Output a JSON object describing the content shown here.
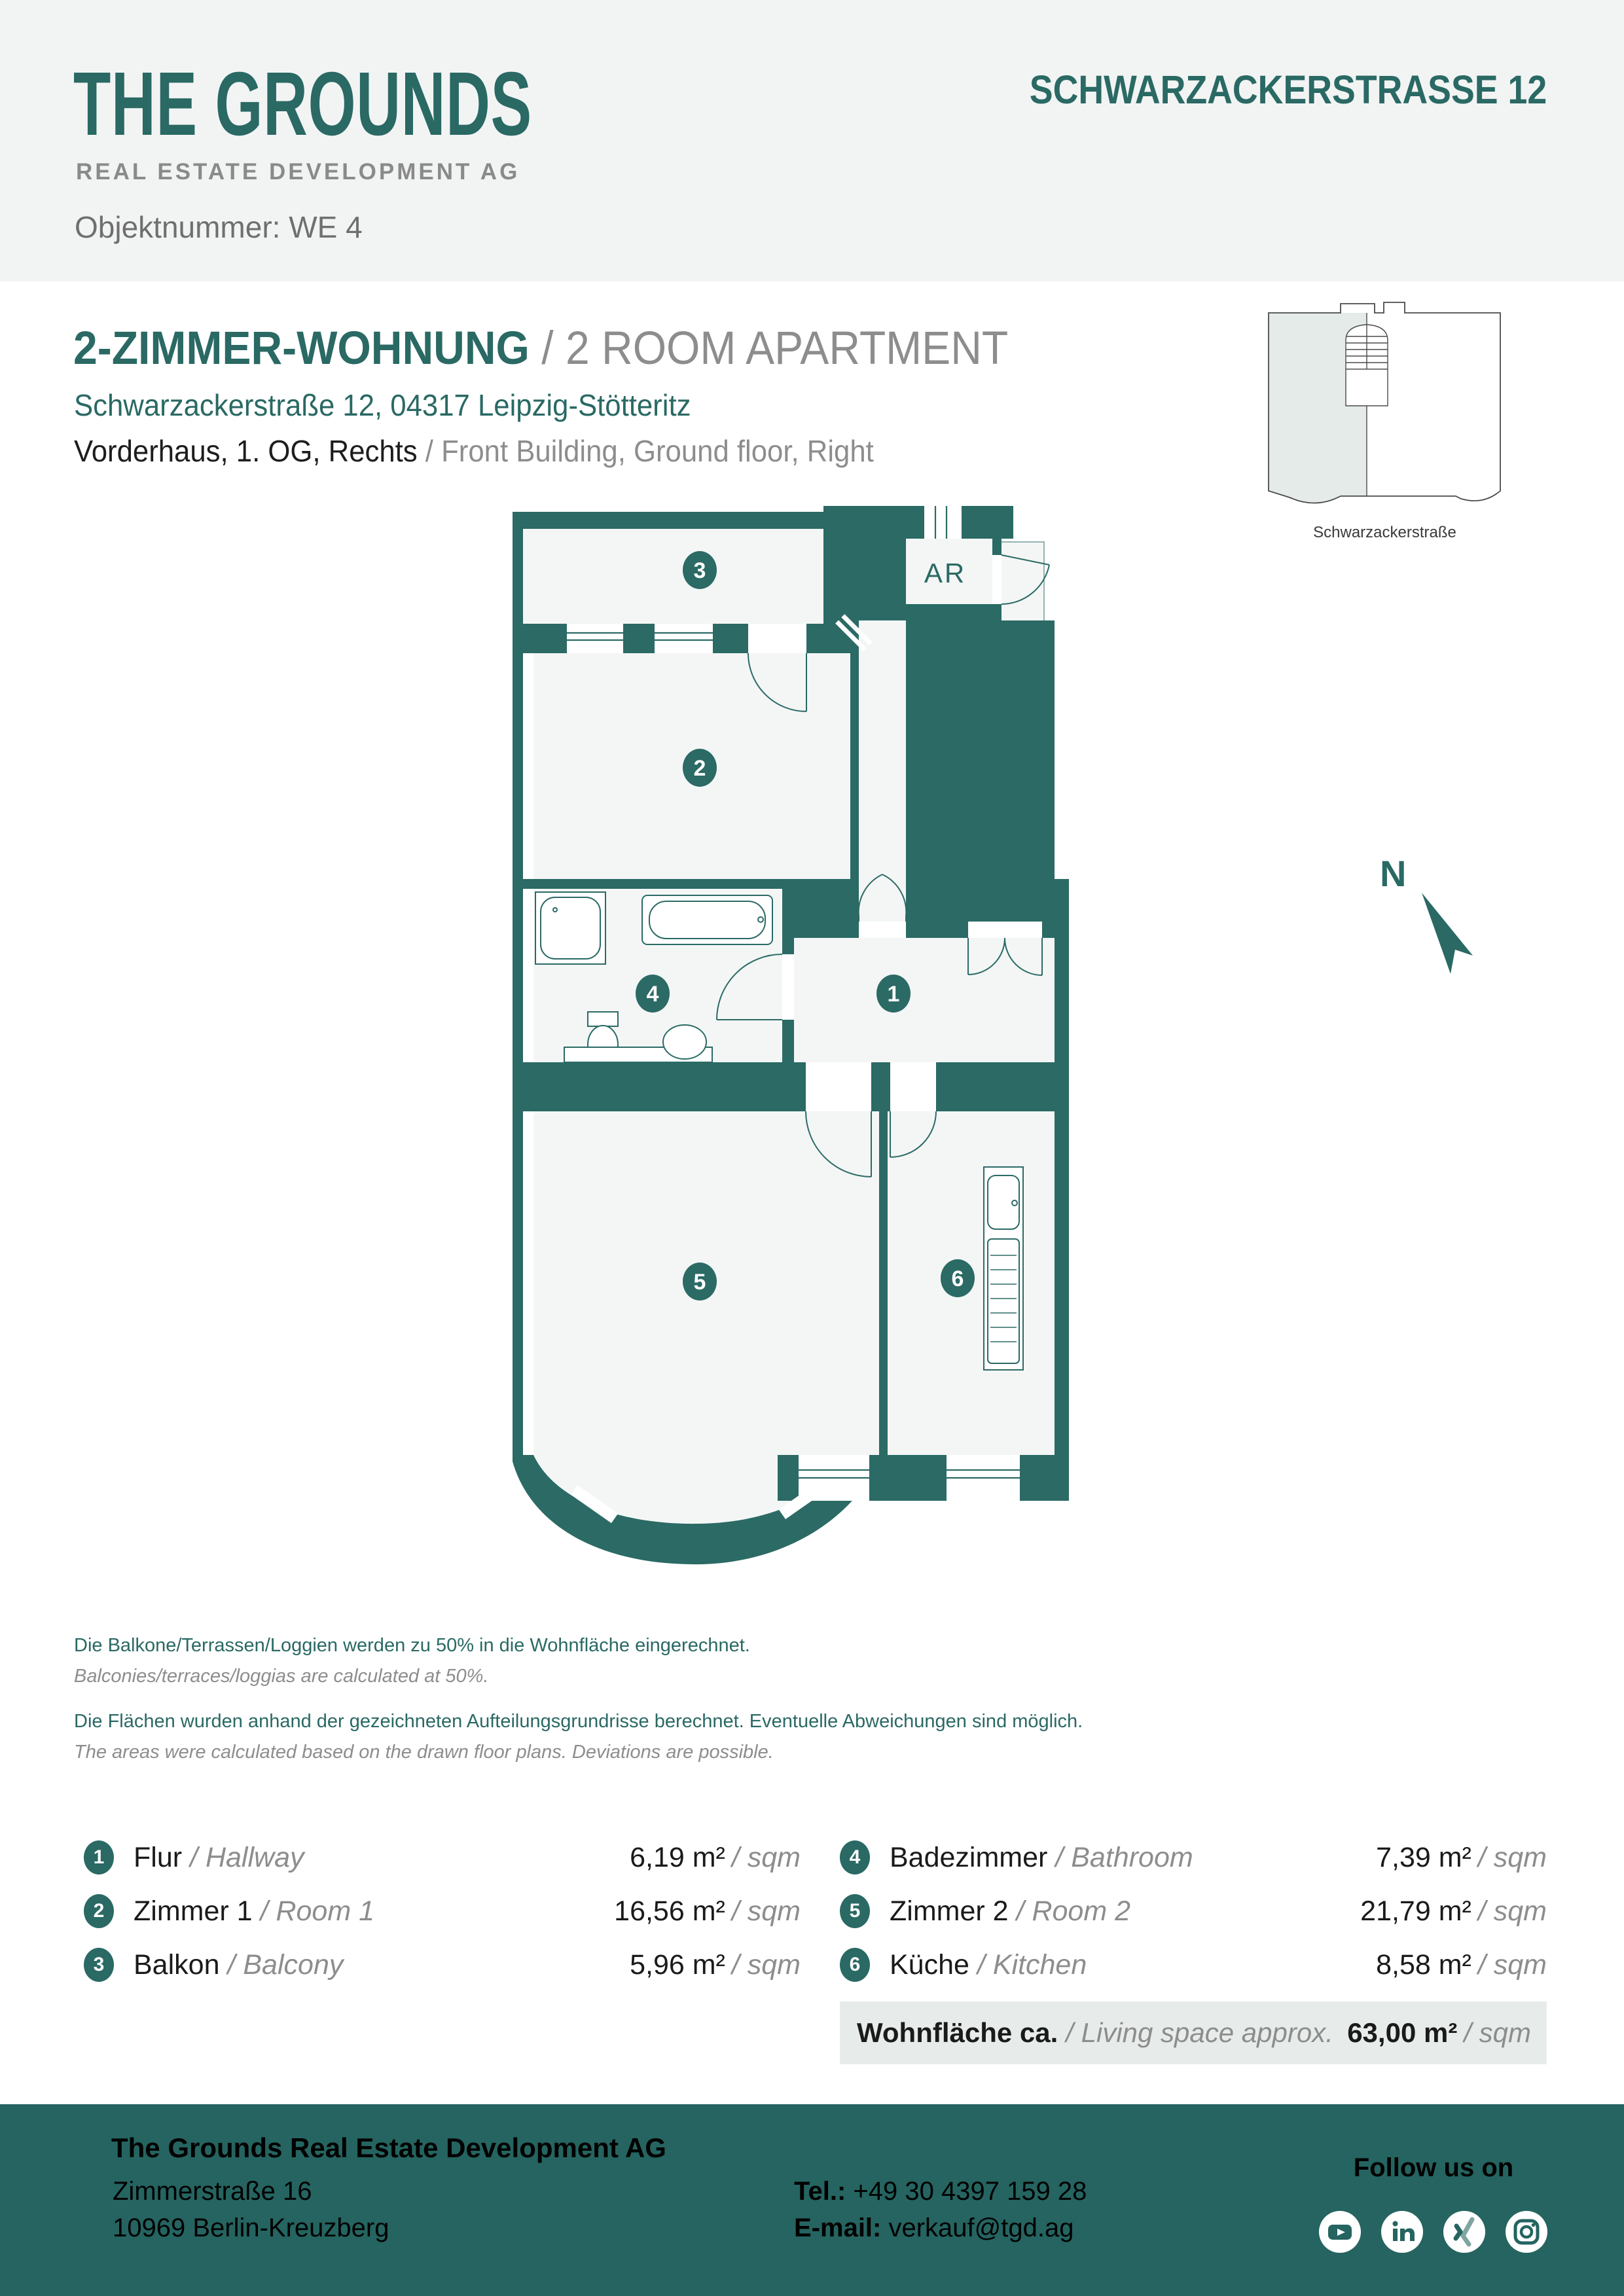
{
  "header": {
    "logo_line1": "THE GROUNDS",
    "logo_line2": "REAL ESTATE DEVELOPMENT AG",
    "object_number": "Objektnummer: WE 4",
    "title": "SCHWARZACKERSTRASSE 12"
  },
  "intro": {
    "title_de": "2-ZIMMER-WOHNUNG",
    "title_en": " / 2 ROOM APARTMENT",
    "address": "Schwarzackerstraße 12, 04317 Leipzig-Stötteritz",
    "location_de": "Vorderhaus, 1. OG, Rechts",
    "location_en": " / Front Building, Ground floor, Right"
  },
  "minimap": {
    "street_label": "Schwarzackerstraße"
  },
  "floorplan": {
    "ar_label": "AR",
    "north_label": "N",
    "badges": [
      "1",
      "2",
      "3",
      "4",
      "5",
      "6"
    ]
  },
  "disclaimer": {
    "de1": "Die Balkone/Terrassen/Loggien werden  zu 50% in die Wohnfläche eingerechnet.",
    "en1": "Balconies/terraces/loggias are calculated at 50%.",
    "de2": "Die Flächen wurden anhand der gezeichneten Aufteilungsgrundrisse berechnet. Eventuelle Abweichungen sind möglich.",
    "en2": "The areas were calculated based on the drawn floor plans. Deviations are possible."
  },
  "legend": {
    "left": [
      {
        "num": "1",
        "name_de": "Flur",
        "name_en": "/ Hallway",
        "area": "6,19 m²",
        "unit": "/ sqm"
      },
      {
        "num": "2",
        "name_de": "Zimmer 1",
        "name_en": "/ Room 1",
        "area": "16,56 m²",
        "unit": "/ sqm"
      },
      {
        "num": "3",
        "name_de": "Balkon",
        "name_en": "/ Balcony",
        "area": "5,96 m²",
        "unit": "/ sqm"
      }
    ],
    "right": [
      {
        "num": "4",
        "name_de": "Badezimmer",
        "name_en": "/ Bathroom",
        "area": "7,39 m²",
        "unit": "/ sqm"
      },
      {
        "num": "5",
        "name_de": "Zimmer 2",
        "name_en": "/ Room 2",
        "area": "21,79 m²",
        "unit": "/ sqm"
      },
      {
        "num": "6",
        "name_de": "Küche",
        "name_en": "/ Kitchen",
        "area": "8,58 m²",
        "unit": "/ sqm"
      }
    ],
    "total": {
      "label_de": "Wohnfläche ca.",
      "label_en": "/ Living space approx.",
      "area": "63,00 m²",
      "unit": "/ sqm"
    }
  },
  "footer": {
    "company": "The Grounds Real Estate Development AG",
    "street": "Zimmerstraße 16",
    "city": "10969 Berlin-Kreuzberg",
    "tel_label": "Tel.:",
    "tel": " +49 30 4397 159 28",
    "email_label": "E-mail:",
    "email": " verkauf@tgd.ag",
    "follow": "Follow us on",
    "social": [
      "youtube",
      "linkedin",
      "xing",
      "instagram"
    ]
  },
  "colors": {
    "teal": "#2A6964",
    "wall": "#2B6A65",
    "gray_text": "#8D8D8D",
    "header_bg": "#F2F4F3",
    "room_fill": "#F3F6F5",
    "total_bg": "#E7ECEB",
    "footer_bg": "#256460"
  }
}
